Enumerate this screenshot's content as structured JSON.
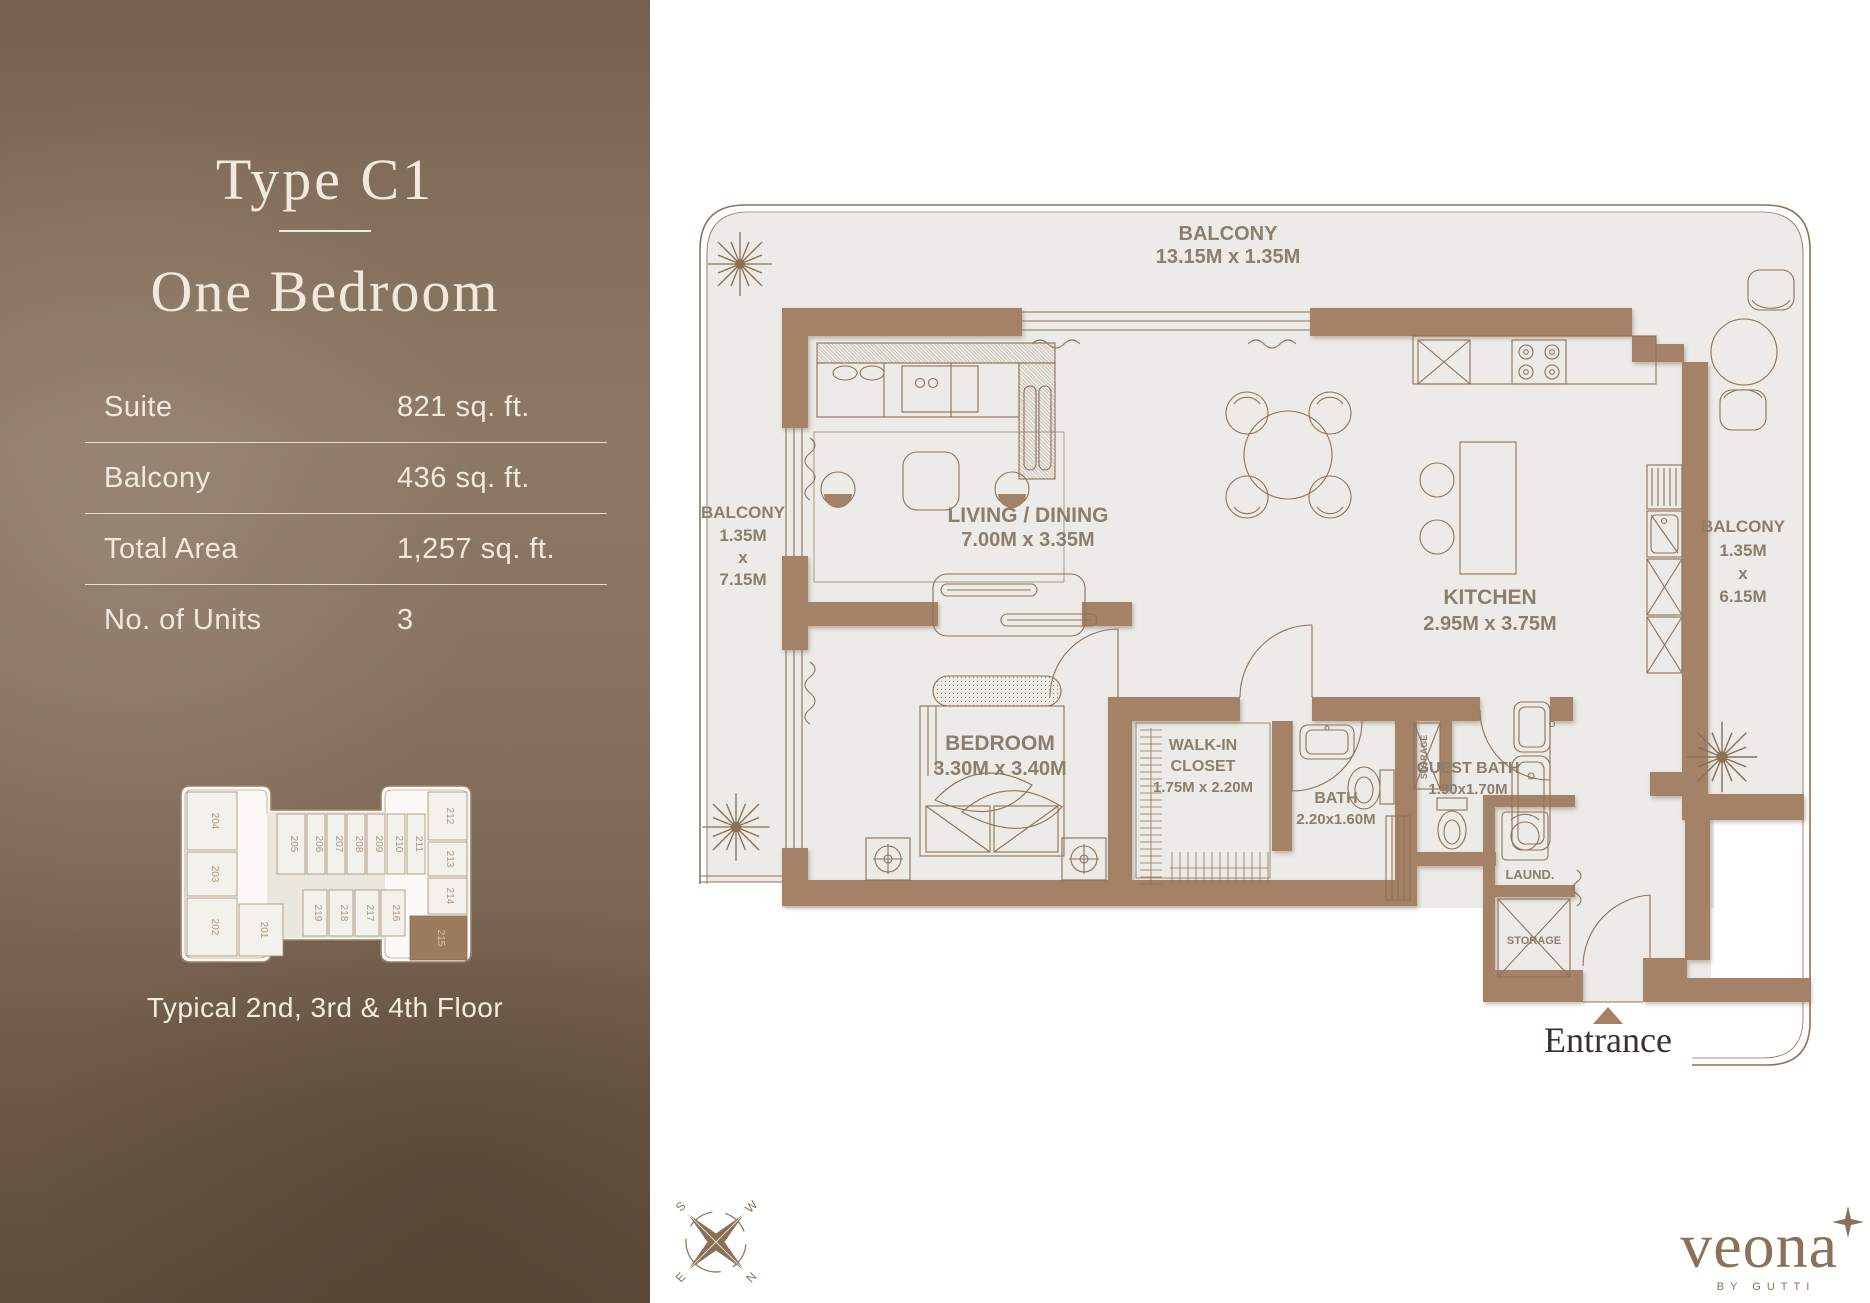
{
  "sidebar": {
    "title_line1": "Type C1",
    "title_line2": "One Bedroom",
    "stats": [
      {
        "label": "Suite",
        "value": "821 sq. ft."
      },
      {
        "label": "Balcony",
        "value": "436 sq. ft."
      },
      {
        "label": "Total Area",
        "value": "1,257 sq. ft."
      },
      {
        "label": "No. of Units",
        "value": "3"
      }
    ],
    "keyplan_caption": "Typical 2nd, 3rd & 4th Floor",
    "keyplan": {
      "units": [
        "204",
        "203",
        "202",
        "201",
        "205",
        "206",
        "207",
        "208",
        "209",
        "210",
        "211",
        "212",
        "213",
        "214",
        "215",
        "216",
        "217",
        "218",
        "219"
      ],
      "highlighted_unit": "215"
    }
  },
  "plan": {
    "balcony_top": [
      "BALCONY",
      "13.15M x 1.35M"
    ],
    "balcony_left": [
      "BALCONY",
      "1.35M",
      "x",
      "7.15M"
    ],
    "balcony_right": [
      "BALCONY",
      "1.35M",
      "x",
      "6.15M"
    ],
    "living": [
      "LIVING / DINING",
      "7.00M x 3.35M"
    ],
    "kitchen": [
      "KITCHEN",
      "2.95M x 3.75M"
    ],
    "bedroom": [
      "BEDROOM",
      "3.30M x 3.40M"
    ],
    "walk_in_closet": [
      "WALK-IN",
      "CLOSET",
      "1.75M x 2.20M"
    ],
    "bath": [
      "BATH",
      "2.20x1.60M"
    ],
    "guest_bath": [
      "GUEST BATH",
      "1.90x1.70M"
    ],
    "laundry": "LAUND.",
    "storage_closet": "STORAGE",
    "storage_room": "STORAGE",
    "entrance": "Entrance",
    "compass": {
      "n": "N",
      "e": "E",
      "s": "S",
      "w": "W"
    }
  },
  "brand": {
    "logo": "veona",
    "tagline": "BY GUTTI"
  },
  "colors": {
    "sidebar_brown": "#85705e",
    "wall_brown": "#a38268",
    "floor_grey": "#ecebe7",
    "line_brown": "#8f7257",
    "cream_text": "#f2e8db",
    "logo_brown": "#8a7158",
    "plan_text": "#8c7e6e"
  }
}
